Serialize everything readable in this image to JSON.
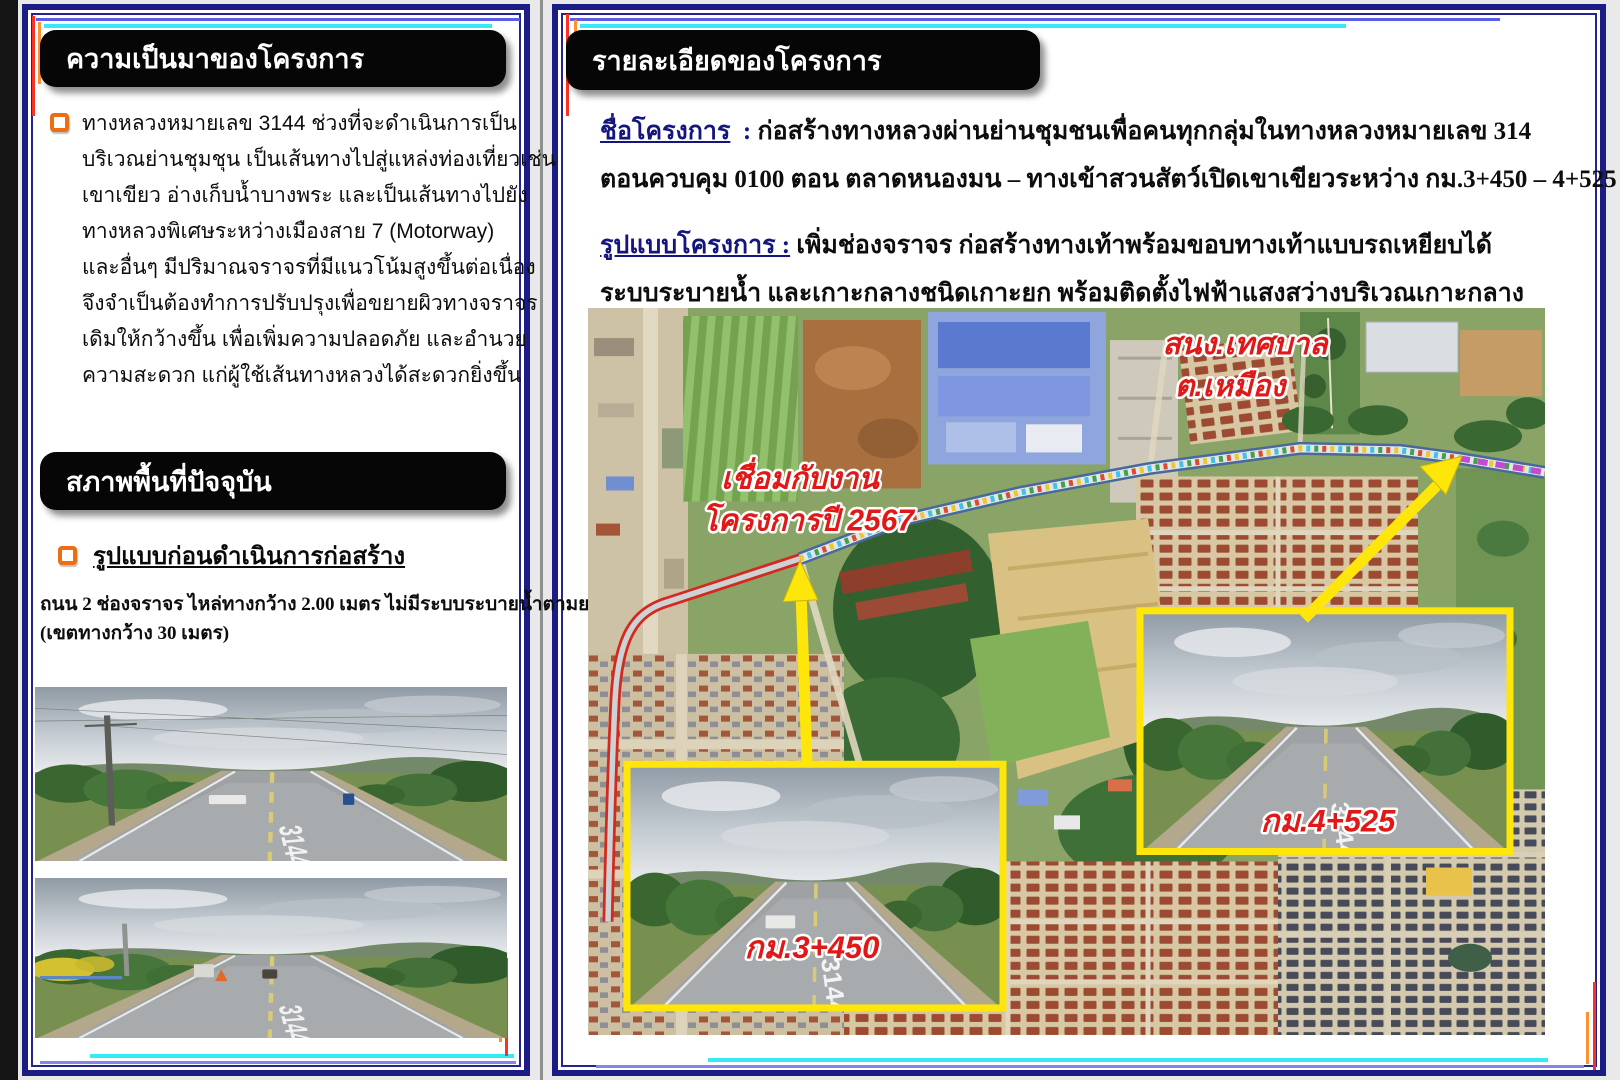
{
  "doc": {
    "type": "โปสเตอร์ประชาสัมพันธ์โครงการ",
    "road_number": "3144"
  },
  "left_panel": {
    "header1": "ความเป็นมาของโครงการ",
    "paragraph1_lines": [
      "ทางหลวงหมายเลข 3144 ช่วงที่จะดำเนินการเป็น",
      "บริเวณย่านชุมชุน เป็นเส้นทางไปสู่แหล่งท่องเที่ยวเช่น",
      "เขาเขียว อ่างเก็บน้ำบางพระ และเป็นเส้นทางไปยัง",
      "ทางหลวงพิเศษระหว่างเมืองสาย 7 (Motorway)",
      "และอื่นๆ มีปริมาณจราจรที่มีแนวโน้มสูงขึ้นต่อเนื่อง",
      "จึงจำเป็นต้องทำการปรับปรุงเพื่อขยายผิวทางจราจร",
      "เดิมให้กว้างขึ้น เพื่อเพิ่มความปลอดภัย และอำนวย",
      "ความสะดวก แก่ผู้ใช้เส้นทางหลวงได้สะดวกยิ่งขึ้น"
    ],
    "header2": "สภาพพื้นที่ปัจจุบัน",
    "subheading": "รูปแบบก่อนดำเนินการก่อสร้าง",
    "current_condition_lines": [
      "ถนน 2 ช่องจราจร ไหล่ทางกว้าง 2.00 เมตร ไม่มีระบบระบายน้ำตามยาว",
      "(เขตทางกว้าง 30 เมตร)"
    ]
  },
  "right_panel": {
    "header": "รายละเอียดของโครงการ",
    "project_name": {
      "label": "ชื่อโครงการ",
      "colon": " : ",
      "line1": "ก่อสร้างทางหลวงผ่านย่านชุมชนเพื่อคนทุกกลุ่มในทางหลวงหมายเลข 314",
      "line2": "ตอนควบคุม 0100 ตอน ตลาดหนองมน – ทางเข้าสวนสัตว์เปิดเขาเขียวระหว่าง กม.3+450 – 4+525"
    },
    "project_form": {
      "label": "รูปแบบโครงการ :",
      "line1": "เพิ่มช่องจราจร ก่อสร้างทางเท้าพร้อมขอบทางเท้าแบบรถเหยียบได้",
      "line2": "ระบบระบายน้ำ และเกาะกลางชนิดเกาะยก พร้อมติดตั้งไฟฟ้าแสงสว่างบริเวณเกาะกลาง"
    },
    "map": {
      "label_municipality_line1": "สนง.เทศบาล",
      "label_municipality_line2": "ต.เหมือง",
      "label_connect_line1": "เชื่อมกับงาน",
      "label_connect_line2": "โครงการปี 2567",
      "inset1_label": "กม.3+450",
      "inset2_label": "กม.4+525",
      "painted_road_number": "3144"
    }
  },
  "colors": {
    "panel_border_navy": "#1c1c85",
    "header_black": "#060606",
    "accent_cyan_line": "#36e9f6",
    "accent_blue_line": "#5b5bec",
    "accent_red_line": "#f93222",
    "accent_orange_line": "#ff9130",
    "bullet_orange": "#ee6c12",
    "label_navy": "#15157e",
    "map_label_red": "#e01818",
    "highlight_yellow": "#ffe60a"
  }
}
